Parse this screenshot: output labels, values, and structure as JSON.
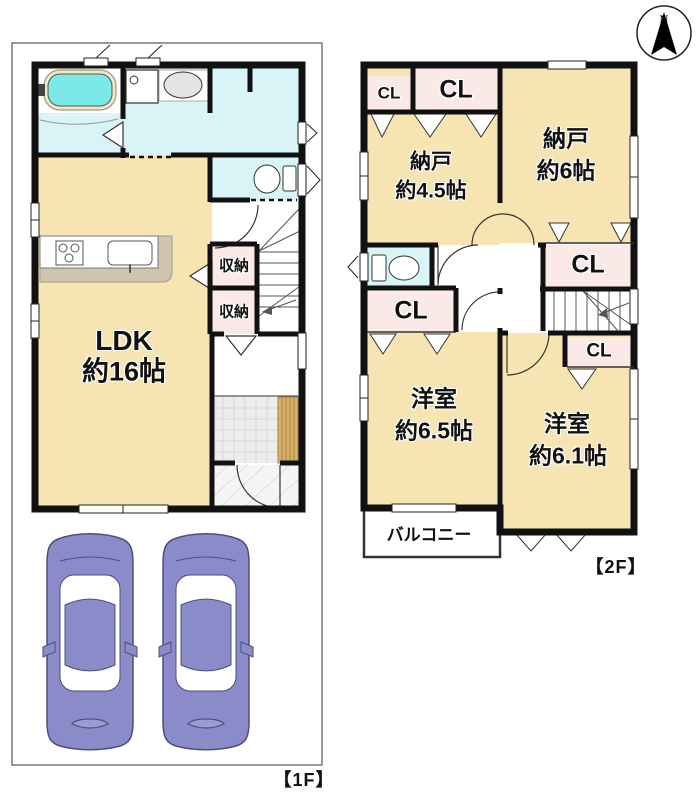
{
  "compass": {
    "north": "N"
  },
  "floor1": {
    "label": "【1F】",
    "ldk_name": "LDK",
    "ldk_size": "約16帖",
    "storage_a": "収納",
    "storage_b": "収納"
  },
  "floor2": {
    "label": "【2F】",
    "nando_small_name": "納戸",
    "nando_small_size": "約4.5帖",
    "nando_large_name": "納戸",
    "nando_large_size": "約6帖",
    "cl_top_left": "CL",
    "cl_top": "CL",
    "cl_east": "CL",
    "cl_east_small": "CL",
    "cl_west": "CL",
    "yoshitsu_65_name": "洋室",
    "yoshitsu_65_size": "約6.5帖",
    "yoshitsu_61_name": "洋室",
    "yoshitsu_61_size": "約6.1帖",
    "balcony": "バルコニー"
  },
  "colors": {
    "room_beige": "#f6e5b2",
    "water_cyan": "#d9f4f6",
    "closet_pink": "#fbe9e8",
    "tub_cyan": "#7ce9e9",
    "car_purple": "#8a8cc9",
    "wood_step": "#d8b268",
    "wall_black": "#111111"
  }
}
